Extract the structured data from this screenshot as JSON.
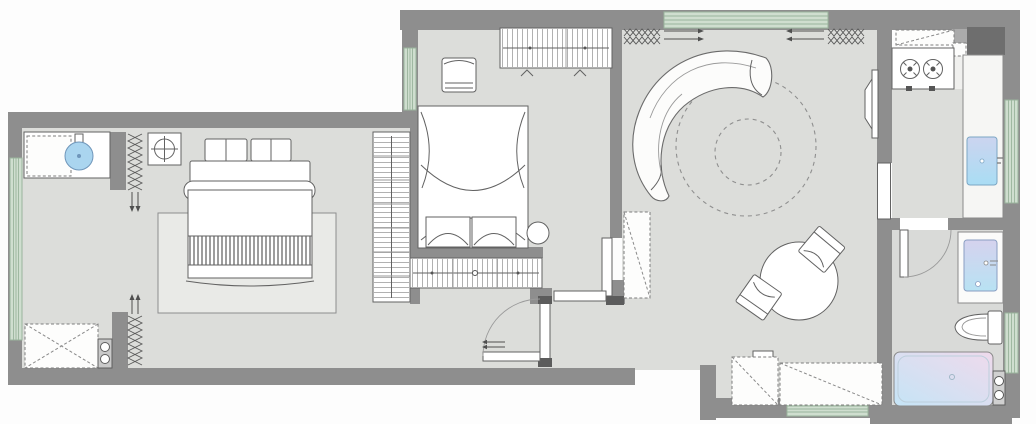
{
  "document": {
    "kind": "residential apartment floor plan drawing",
    "visible_text": [],
    "orientation": "landscape"
  },
  "palette": {
    "background": "#fdfdfd",
    "wall": "#8e8e8e",
    "wall_dark": "#6e6e6e",
    "floor": "#dcddda",
    "floor_kitchen": "#f0f0ee",
    "floor_bath": "#d9dad8",
    "window_fill": "#cfdecf",
    "window_line": "#9ab49c",
    "furniture_fill": "#ffffff",
    "outline": "#626262",
    "water_blue": "#a9d5ef",
    "tub_gradient": [
      "#c5e4f6",
      "#efdaec"
    ],
    "basin_gradient": [
      "#d5d2ee",
      "#b8e2f3"
    ]
  },
  "rooms": [
    {
      "id": "bedroom-main",
      "fixtures": [
        "double-bed",
        "area-rug",
        "headboard-cushions",
        "striped-blanket",
        "laundry-counter",
        "washer-dashed",
        "round-sink",
        "fan-drain-symbol",
        "storage-cabinet-x",
        "knob-unit",
        "curtain-symbols",
        "side-wardrobe"
      ]
    },
    {
      "id": "bedroom-second",
      "fixtures": [
        "canopy-bed",
        "foot-benches",
        "round-side-stool",
        "cube-chair",
        "wardrobe-north",
        "wardrobe-south",
        "sliding-door-leaf"
      ]
    },
    {
      "id": "living-room",
      "fixtures": [
        "curved-sofa",
        "round-rug-dashed",
        "wall-tv",
        "round-dining-table",
        "dining-chair-ne",
        "dining-chair-sw",
        "window-bench-x",
        "standing-mirror-dashed",
        "curtain-symbols",
        "entry-door-swing",
        "sliding-partition"
      ]
    },
    {
      "id": "kitchen",
      "fixtures": [
        "two-burner-stove",
        "counter",
        "upper-cabinet-dashed",
        "flue-duct",
        "kitchen-sink",
        "east-counter",
        "door-leaf"
      ]
    },
    {
      "id": "bathroom",
      "fixtures": [
        "vanity-counter",
        "vanity-basin",
        "toilet",
        "bathtub",
        "knob-unit",
        "door-swing",
        "window"
      ]
    }
  ],
  "windows": {
    "count": 6,
    "style": "triple-line green glazing strips"
  },
  "symbols": {
    "zigzag": "curtain / radiator symbol",
    "dashed_circle": "round rug",
    "dashed_box_x": "low cabinet / bench"
  }
}
